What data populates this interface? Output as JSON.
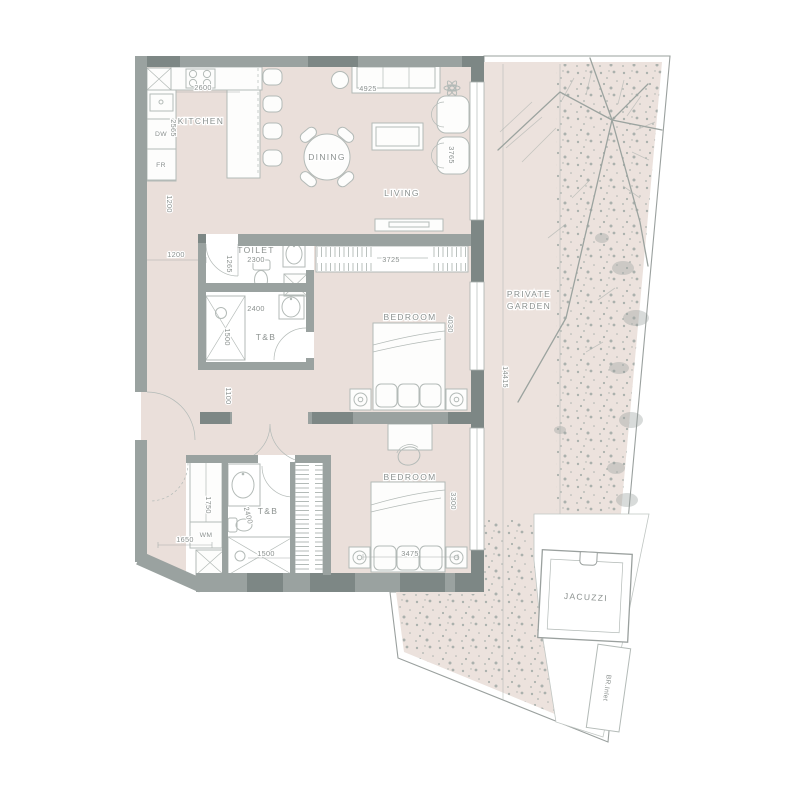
{
  "plan": {
    "rooms": {
      "kitchen": "KITCHEN",
      "dining": "DINING",
      "living": "LIVING",
      "toilet": "TOILET",
      "toilet_tb": "T&B",
      "bedroom_mid": "BEDROOM",
      "bedroom_lower": "BEDROOM",
      "lower_tb": "T&B",
      "garden_line1": "PRIVATE",
      "garden_line2": "GARDEN",
      "jacuzzi": "JACUZZI",
      "br_inlet": "BR.Inlet"
    },
    "appliances": {
      "dw": "DW",
      "fr": "FR",
      "wm": "WM"
    },
    "dims": {
      "kitchen_counter": "2600",
      "kitchen_depth": "2565",
      "entry_hall_v": "1200",
      "entry_hall_h": "1200",
      "toilet_w": "1265",
      "toilet_len": "2300",
      "tb_upper_len": "2400",
      "tb_upper_shower": "1500",
      "hall_mid": "1100",
      "wardrobe_mid": "3725",
      "bedroom_mid_len": "4030",
      "living_window": "3765",
      "sofa_wall": "4925",
      "garden_len": "14415",
      "wm_closet": "1750",
      "utility_w": "1650",
      "tb_lower_len": "2400",
      "tb_lower_shower": "1500",
      "bedroom_lower_w": "3475",
      "bedroom_lower_len": "3300"
    },
    "colors": {
      "floor": "#eadfda",
      "garden": "#ece2dd",
      "wall": "#9aa2a0",
      "wall_dark": "#7d8785",
      "line": "#b3bab7",
      "text": "#8b918f",
      "stipple": "#a4aca8"
    }
  }
}
